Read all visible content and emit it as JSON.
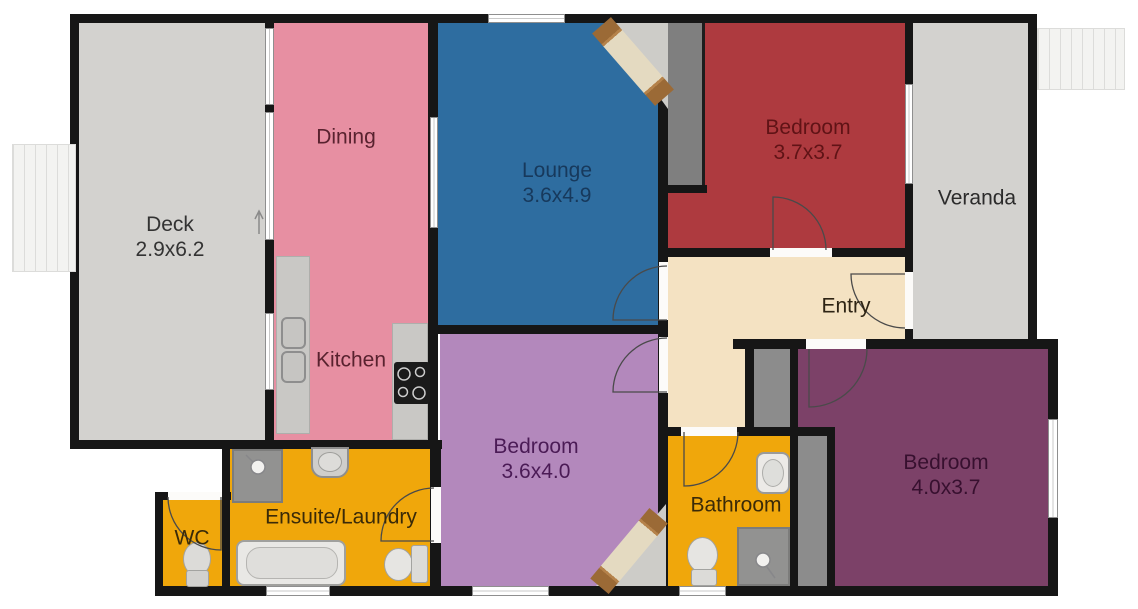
{
  "rooms": {
    "deck": {
      "name": "Deck",
      "dims": "2.9x6.2",
      "fill": "#d3d2cf",
      "text_color": "#333333"
    },
    "dining": {
      "name": "Dining",
      "dims": "",
      "fill": "#e78fa2",
      "text_color": "#59222f"
    },
    "kitchen": {
      "name": "Kitchen",
      "dims": "",
      "fill": "#e78fa2",
      "text_color": "#59222f"
    },
    "lounge": {
      "name": "Lounge",
      "dims": "3.6x4.9",
      "fill": "#2e6da0",
      "text_color": "#17395c"
    },
    "bedroom_top": {
      "name": "Bedroom",
      "dims": "3.7x3.7",
      "fill": "#ae3a3f",
      "text_color": "#601316"
    },
    "veranda": {
      "name": "Veranda",
      "dims": "",
      "fill": "#d3d2cf",
      "text_color": "#2b2b2b"
    },
    "entry": {
      "name": "Entry",
      "dims": "",
      "fill": "#f4e2c2",
      "text_color": "#2e2414"
    },
    "bedroom_mid": {
      "name": "Bedroom",
      "dims": "3.6x4.0",
      "fill": "#b388bc",
      "text_color": "#4b1b56"
    },
    "bathroom": {
      "name": "Bathroom",
      "dims": "",
      "fill": "#f0a70b",
      "text_color": "#3a2a08"
    },
    "ensuite": {
      "name": "Ensuite/Laundry",
      "dims": "",
      "fill": "#f0a70b",
      "text_color": "#3a2a08"
    },
    "wc": {
      "name": "WC",
      "dims": "",
      "fill": "#f0a70b",
      "text_color": "#3a2a08"
    },
    "bedroom_right": {
      "name": "Bedroom",
      "dims": "4.0x3.7",
      "fill": "#7c4168",
      "text_color": "#37102f"
    }
  },
  "colors": {
    "wall": "#161616",
    "window": "#ffffff",
    "counter": "#c9c8c5",
    "appliance": "#1b1b1b",
    "closet": "#8c8c8c",
    "chimney": "#7f7f7f",
    "shower": "#929291",
    "fixture": "#e9e8e5",
    "fixture_dark": "#d9d8d5",
    "stairs": "#f0f0ee",
    "fireplace_back": "#cdccc8",
    "fireplace_brick": "#9b6a36",
    "fireplace_mid": "#e4dac1",
    "arc_stroke": "#4a4a4a"
  }
}
